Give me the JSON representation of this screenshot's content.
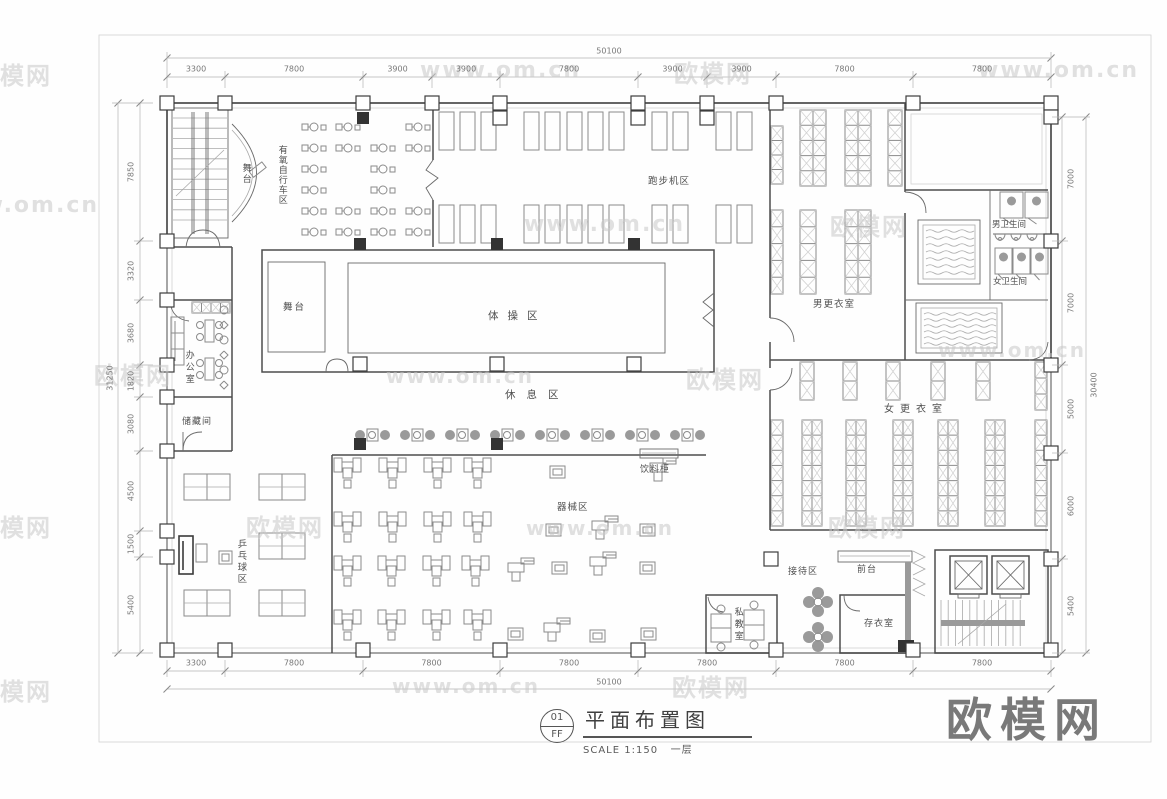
{
  "sheet": {
    "title_block": {
      "number": "01",
      "code": "FF",
      "title": "平面布置图",
      "scale": "SCALE 1:150",
      "floor": "一层"
    }
  },
  "rooms": [
    {
      "id": "stage-upper",
      "text": "舞台",
      "x": 240,
      "y": 163,
      "v": true,
      "s": 9,
      "ls": 2
    },
    {
      "id": "aerobic-bike-area",
      "text": "有氧自行车区",
      "x": 276,
      "y": 145,
      "v": true,
      "s": 9,
      "ls": 1
    },
    {
      "id": "treadmill-area",
      "text": "跑步机区",
      "x": 648,
      "y": 176,
      "v": false,
      "s": 9.5,
      "ls": 1
    },
    {
      "id": "stage-main",
      "text": "舞台",
      "x": 283,
      "y": 302,
      "v": false,
      "s": 9.5,
      "ls": 2
    },
    {
      "id": "gymnastics-area",
      "text": "体操区",
      "x": 488,
      "y": 310,
      "v": false,
      "s": 10.5,
      "ls": 9
    },
    {
      "id": "rest-area",
      "text": "休息区",
      "x": 505,
      "y": 389,
      "v": false,
      "s": 10.5,
      "ls": 11
    },
    {
      "id": "office",
      "text": "办公室",
      "x": 183,
      "y": 350,
      "v": true,
      "s": 9,
      "ls": 3
    },
    {
      "id": "storage",
      "text": "储藏间",
      "x": 182,
      "y": 417,
      "v": false,
      "s": 9,
      "ls": 1
    },
    {
      "id": "mens-locker",
      "text": "男更衣室",
      "x": 813,
      "y": 299,
      "v": false,
      "s": 9.5,
      "ls": 1
    },
    {
      "id": "mens-wc",
      "text": "男卫生间",
      "x": 992,
      "y": 220,
      "v": false,
      "s": 8.5,
      "ls": 0
    },
    {
      "id": "womens-wc",
      "text": "女卫生间",
      "x": 993,
      "y": 277,
      "v": false,
      "s": 8.5,
      "ls": 0
    },
    {
      "id": "womens-locker",
      "text": "女更衣室",
      "x": 884,
      "y": 404,
      "v": false,
      "s": 10,
      "ls": 6
    },
    {
      "id": "equipment-area",
      "text": "器械区",
      "x": 557,
      "y": 502,
      "v": false,
      "s": 9.5,
      "ls": 1
    },
    {
      "id": "drink-cabinet",
      "text": "饮料柜",
      "x": 640,
      "y": 465,
      "v": false,
      "s": 9,
      "ls": 1
    },
    {
      "id": "pingpong-area",
      "text": "乒乓球区",
      "x": 235,
      "y": 539,
      "v": true,
      "s": 9.5,
      "ls": 2
    },
    {
      "id": "private-coach-room",
      "text": "私教室",
      "x": 732,
      "y": 607,
      "v": true,
      "s": 9,
      "ls": 3
    },
    {
      "id": "reception-area",
      "text": "接待区",
      "x": 788,
      "y": 567,
      "v": false,
      "s": 9,
      "ls": 1
    },
    {
      "id": "front-desk",
      "text": "前台",
      "x": 857,
      "y": 565,
      "v": false,
      "s": 9,
      "ls": 1
    },
    {
      "id": "cloakroom",
      "text": "存衣室",
      "x": 864,
      "y": 619,
      "v": false,
      "s": 9,
      "ls": 1
    }
  ],
  "dimensions": {
    "top": {
      "total": "50100",
      "segments": [
        "3300",
        "7800",
        "3900",
        "3900",
        "7800",
        "3900",
        "3900",
        "7800",
        "7800"
      ]
    },
    "bottom": {
      "total": "50100",
      "segments": [
        "3300",
        "7800",
        "7800",
        "7800",
        "7800",
        "7800",
        "7800"
      ]
    },
    "left": {
      "total": "31250",
      "segments": [
        "7850",
        "3320",
        "3680",
        "1820",
        "3080",
        "4500",
        "1500",
        "5400"
      ]
    },
    "right": {
      "total": "30400",
      "segments": [
        "7000",
        "7000",
        "5000",
        "6000",
        "5400"
      ]
    }
  },
  "watermarks": [
    {
      "text": "欧模网",
      "x": -26,
      "y": 56,
      "s": 24
    },
    {
      "text": "www.om.cn",
      "x": 420,
      "y": 58,
      "s": 22
    },
    {
      "text": "欧模网",
      "x": 674,
      "y": 54,
      "s": 24
    },
    {
      "text": "www.om.cn",
      "x": 978,
      "y": 58,
      "s": 22
    },
    {
      "text": "www.om.cn",
      "x": -62,
      "y": 193,
      "s": 22
    },
    {
      "text": "www.om.cn",
      "x": 524,
      "y": 212,
      "s": 22
    },
    {
      "text": "欧模网",
      "x": 830,
      "y": 207,
      "s": 24
    },
    {
      "text": "欧模网",
      "x": 94,
      "y": 356,
      "s": 24
    },
    {
      "text": "www.om.cn",
      "x": 386,
      "y": 364,
      "s": 20
    },
    {
      "text": "欧模网",
      "x": 686,
      "y": 360,
      "s": 24
    },
    {
      "text": "www.om.cn",
      "x": 938,
      "y": 338,
      "s": 20
    },
    {
      "text": "欧模网",
      "x": -26,
      "y": 508,
      "s": 24
    },
    {
      "text": "欧模网",
      "x": 246,
      "y": 508,
      "s": 24
    },
    {
      "text": "www.om.cn",
      "x": 526,
      "y": 516,
      "s": 20
    },
    {
      "text": "欧模网",
      "x": 828,
      "y": 508,
      "s": 24
    },
    {
      "text": "欧模网",
      "x": -26,
      "y": 672,
      "s": 24
    },
    {
      "text": "www.om.cn",
      "x": 392,
      "y": 674,
      "s": 20
    },
    {
      "text": "欧模网",
      "x": 672,
      "y": 668,
      "s": 24
    },
    {
      "text": "欧模网",
      "x": 946,
      "y": 684,
      "s": 46,
      "big": true
    }
  ]
}
